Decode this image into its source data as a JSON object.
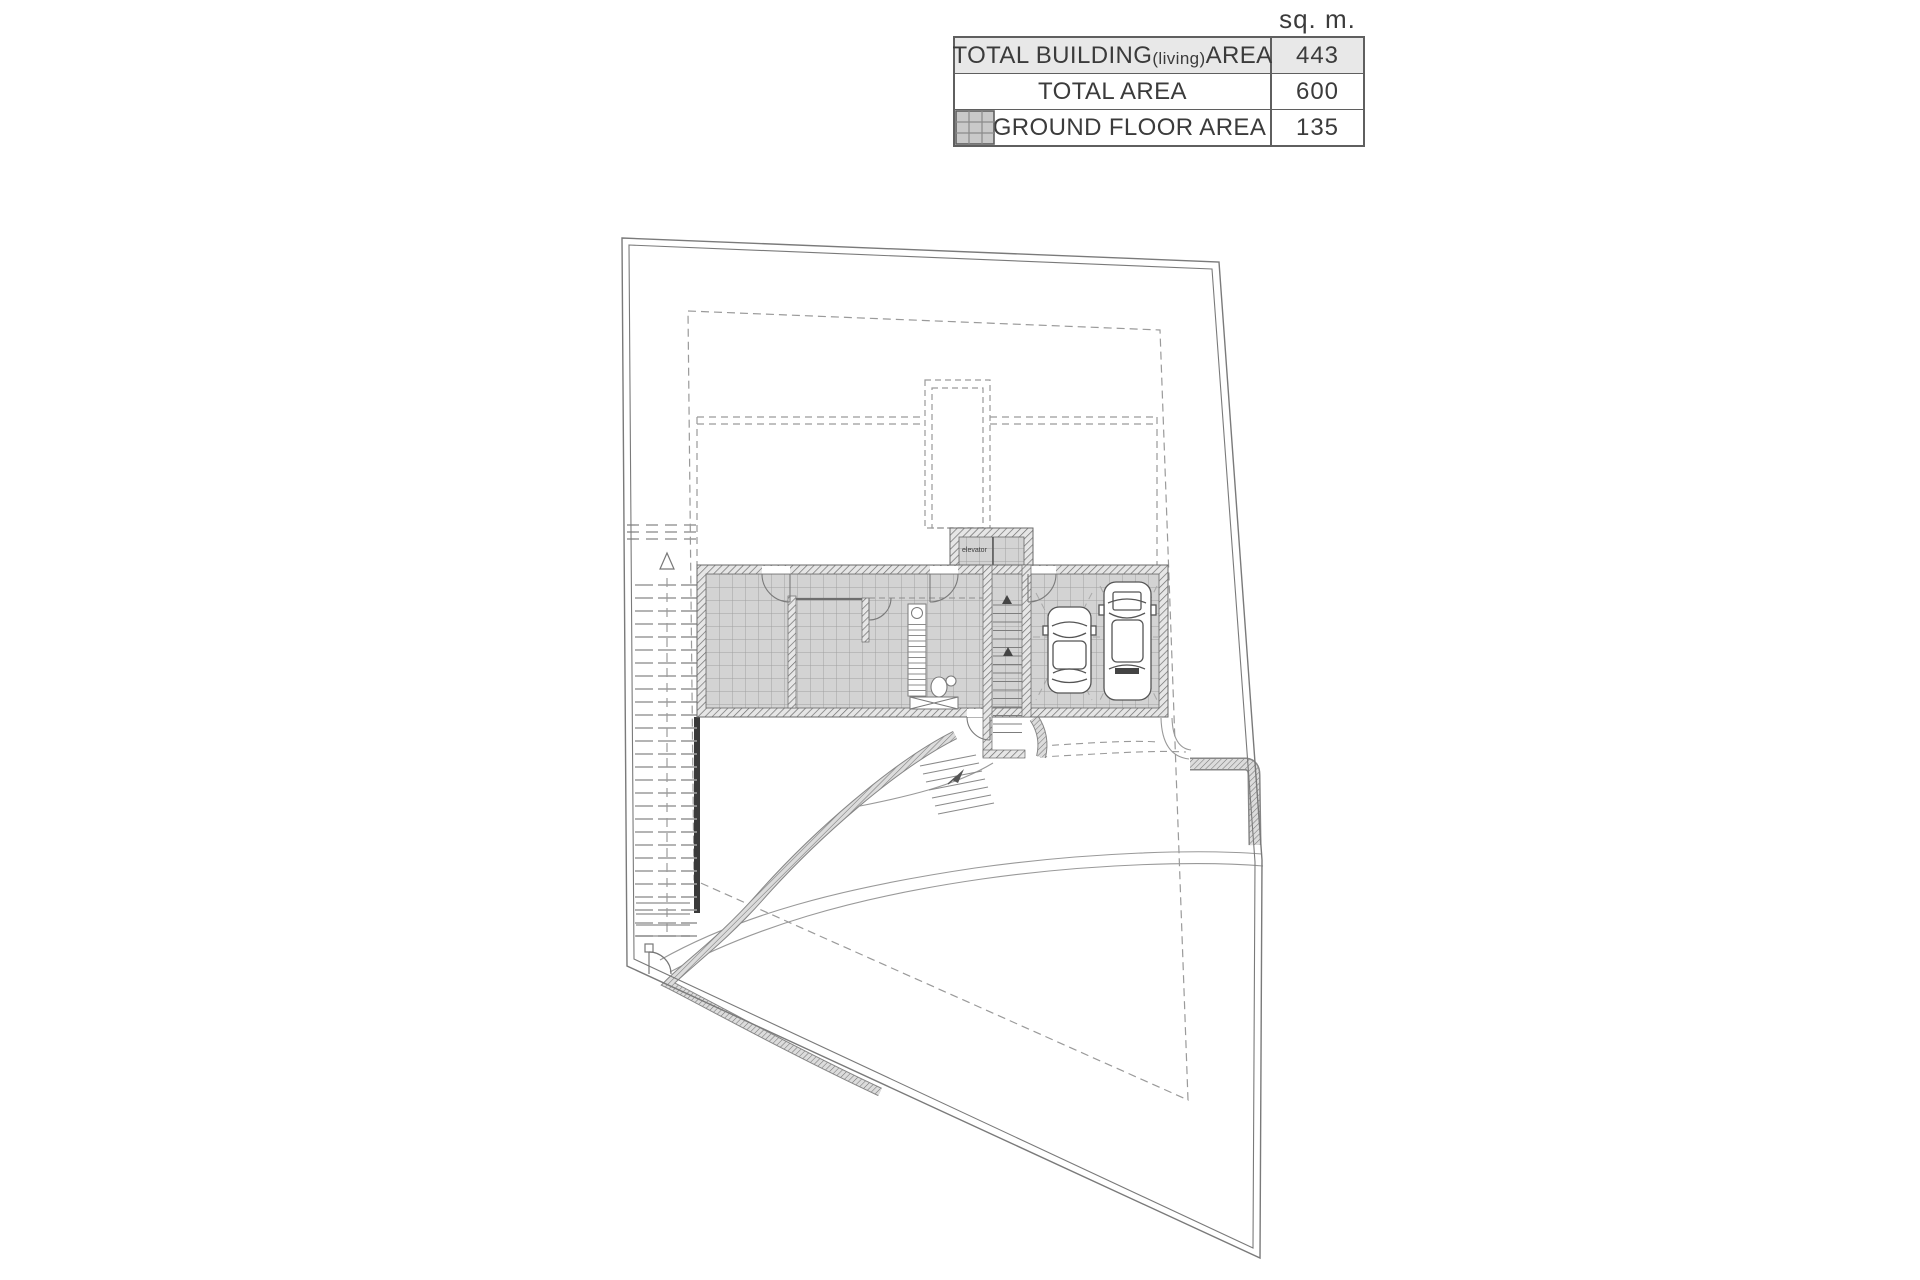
{
  "legend_table": {
    "unit_header": "sq. m.",
    "rows": [
      {
        "label_main": "TOTAL BUILDING",
        "label_sub": "(living)",
        "label_tail": " AREA",
        "value": "443"
      },
      {
        "label_main": "TOTAL AREA",
        "label_sub": "",
        "label_tail": "",
        "value": "600"
      },
      {
        "label_main": "GROUND FLOOR AREA",
        "label_sub": "",
        "label_tail": "",
        "value": "135"
      }
    ],
    "swatch_icon": "ground-floor-hatch-swatch",
    "colors": {
      "row_highlight": "#e8e8e8",
      "border": "#5f5f5f",
      "text": "#3b3b3b",
      "swatch_fill": "#c9c9c9",
      "swatch_grid": "#8a8a8a"
    }
  },
  "site_plan": {
    "labels": {
      "elevator": "elevator"
    },
    "colors": {
      "boundary_line": "#7a7a7a",
      "dashed_outline": "#9a9a9a",
      "wall_hatch": "#6e6e6e",
      "floor_tile": "#d3d3d3",
      "tile_grid": "#a0a0a0",
      "retaining_wall_dark": "#3a3a3a"
    }
  }
}
